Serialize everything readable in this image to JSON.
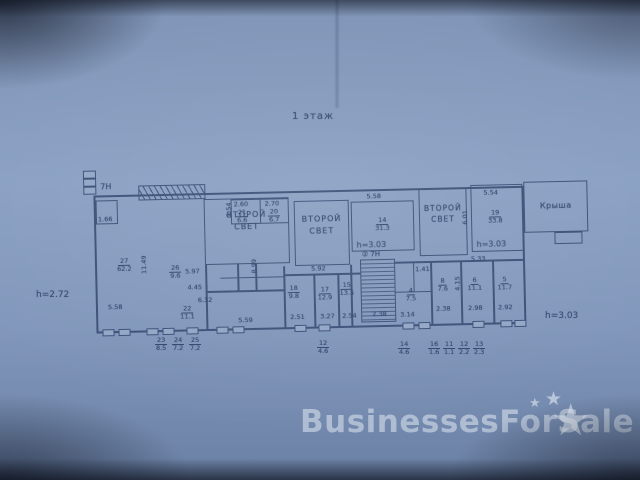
{
  "title": "1 этаж",
  "watermark": {
    "text": "BusinessesForSale",
    "star": "★"
  },
  "plan": {
    "unit_top_left": "7Н",
    "unit_mid": "② 7Н",
    "second_light": {
      "line1": "ВТОРОЙ",
      "line2": "СВЕТ"
    },
    "roof": "Крыша",
    "heights": {
      "left": "h=2.72",
      "mid": "h=3.03",
      "right": "h=3.03",
      "bottom_right": "h=3.03"
    },
    "rooms": {
      "r27": {
        "num": "27",
        "area": "62.2"
      },
      "r26": {
        "num": "26",
        "area": "9.6"
      },
      "r22": {
        "num": "22",
        "area": "11.1"
      },
      "r21": {
        "num": "21",
        "area": "6.6"
      },
      "r20": {
        "num": "20",
        "area": "6.7"
      },
      "r14": {
        "num": "14",
        "area": "31.3"
      },
      "r19": {
        "num": "19",
        "area": "33.8"
      },
      "r18": {
        "num": "18",
        "area": "9.8"
      },
      "r17": {
        "num": "17",
        "area": "12.9"
      },
      "r15": {
        "num": "15",
        "area": "13.5"
      },
      "r8": {
        "num": "8",
        "area": "7.6"
      },
      "r6": {
        "num": "6",
        "area": "11.1"
      },
      "r5": {
        "num": "5",
        "area": "11.7"
      },
      "r4": {
        "num": "4",
        "area": "7.5"
      },
      "closet_area": "1.66"
    },
    "dims": {
      "left_room_height": "11.49",
      "left_room_width": "5.58",
      "d597": "5.97",
      "d445": "4.45",
      "d632": "6.32",
      "d559": "5.59",
      "d899": "8.99",
      "v254": "2.54",
      "d260": "2.60",
      "d270": "2.70",
      "d592": "5.92",
      "d558": "5.58",
      "v601": "6.01",
      "d554": "5.54",
      "d533": "5.33",
      "d251": "2.51",
      "d327": "3.27",
      "d254": "2.54",
      "d238a": "2.38",
      "d141": "1.41",
      "d314": "3.14",
      "v415": "4.15",
      "d238b": "2.38",
      "d298": "2.98",
      "d292": "2.92"
    },
    "marks": [
      {
        "num": "23",
        "den": "8.5"
      },
      {
        "num": "24",
        "den": "7.2"
      },
      {
        "num": "25",
        "den": "7.2"
      },
      {
        "num": "12",
        "den": "4.6"
      },
      {
        "num": "14",
        "den": "4.6"
      },
      {
        "num": "16",
        "den": "1.6"
      },
      {
        "num": "11",
        "den": "1.1"
      },
      {
        "num": "12",
        "den": "2.2"
      },
      {
        "num": "13",
        "den": "2.3"
      }
    ]
  }
}
